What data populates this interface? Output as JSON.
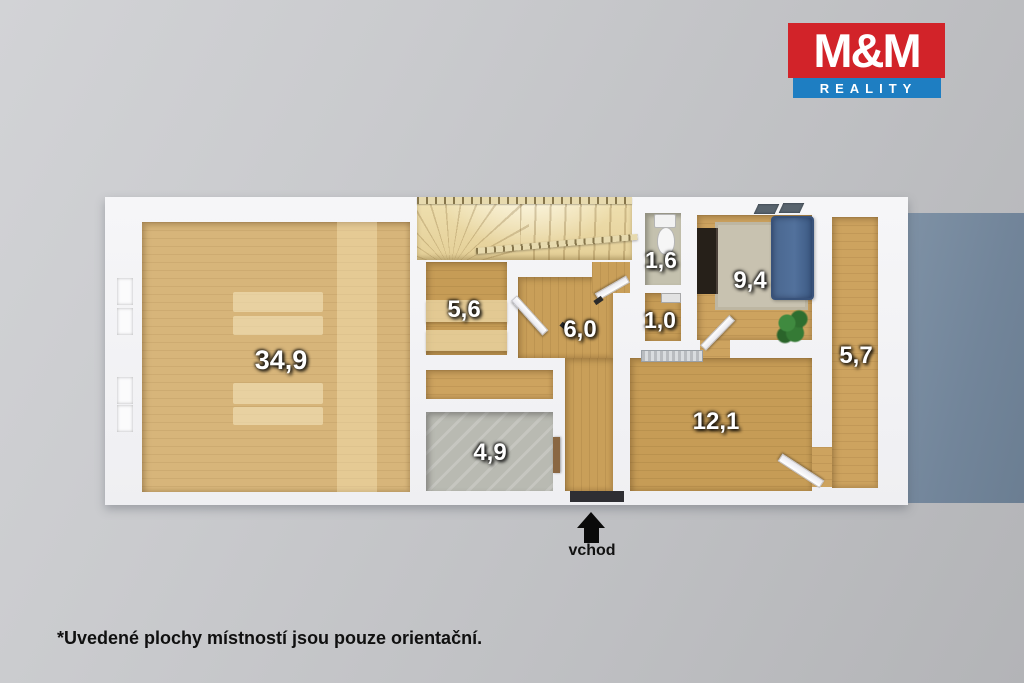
{
  "logo": {
    "title": "M&M",
    "subtitle": "REALITY",
    "brand_red": "#d22329",
    "brand_blue": "#1e7ec2"
  },
  "floorplan": {
    "entrance_label": "vchod",
    "rooms": [
      {
        "area": "34,9"
      },
      {
        "area": "5,6"
      },
      {
        "area": "6,0"
      },
      {
        "area": "1,6"
      },
      {
        "area": "1,0"
      },
      {
        "area": "9,4"
      },
      {
        "area": "5,7"
      },
      {
        "area": "12,1"
      },
      {
        "area": "4,9"
      }
    ]
  },
  "footnote": "*Uvedené plochy místností jsou pouze orientační."
}
